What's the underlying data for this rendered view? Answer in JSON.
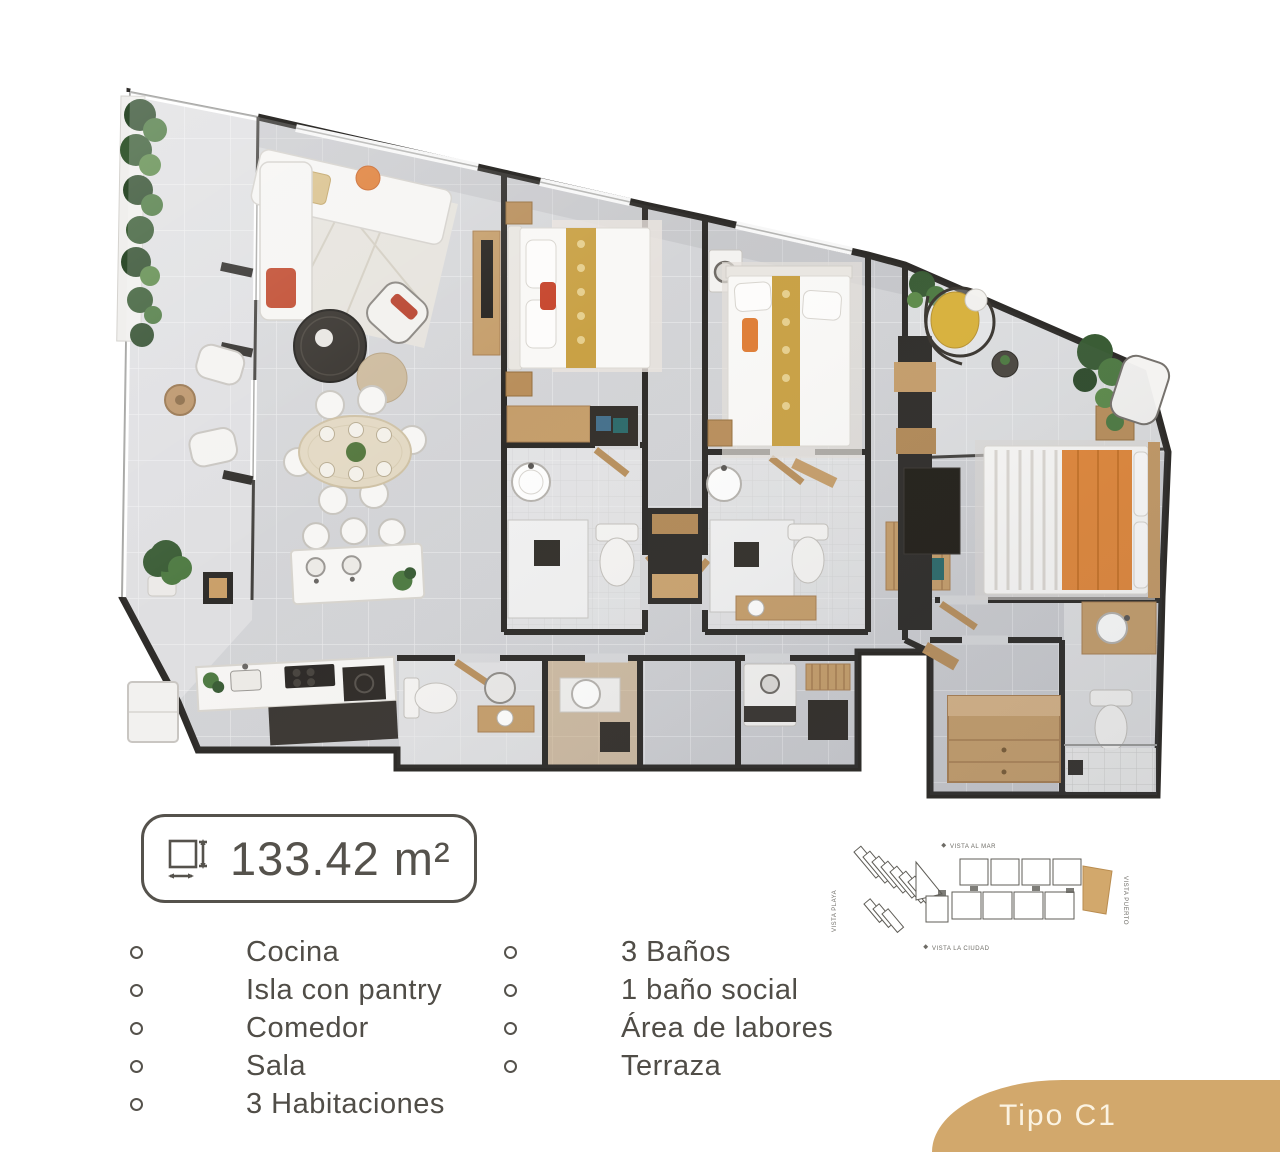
{
  "area_badge": {
    "icon": "area-measure-icon",
    "value": "133.42 m²"
  },
  "features": {
    "left": [
      "Cocina",
      "Isla con pantry",
      "Comedor",
      "Sala",
      "3 Habitaciones"
    ],
    "right": [
      "3 Baños",
      "1 baño social",
      "Área de labores",
      "Terraza"
    ]
  },
  "unit_type": {
    "label": "Tipo C1"
  },
  "site_minimap": {
    "labels": {
      "top": "VISTA AL MAR",
      "bottom": "VISTA LA CIUDAD",
      "left": "VISTA PLAYA",
      "right": "VISTA PUERTO"
    },
    "highlight_color": "#d2a86c"
  },
  "colors": {
    "accent_tan": "#d2a86c",
    "text": "#504d47",
    "wall": "#2e2c29",
    "floor": "#d3d4d6",
    "wood": "#c59e6b",
    "orange": "#df7f38",
    "gold": "#c9a145",
    "plant_green": "#4e7a42"
  }
}
